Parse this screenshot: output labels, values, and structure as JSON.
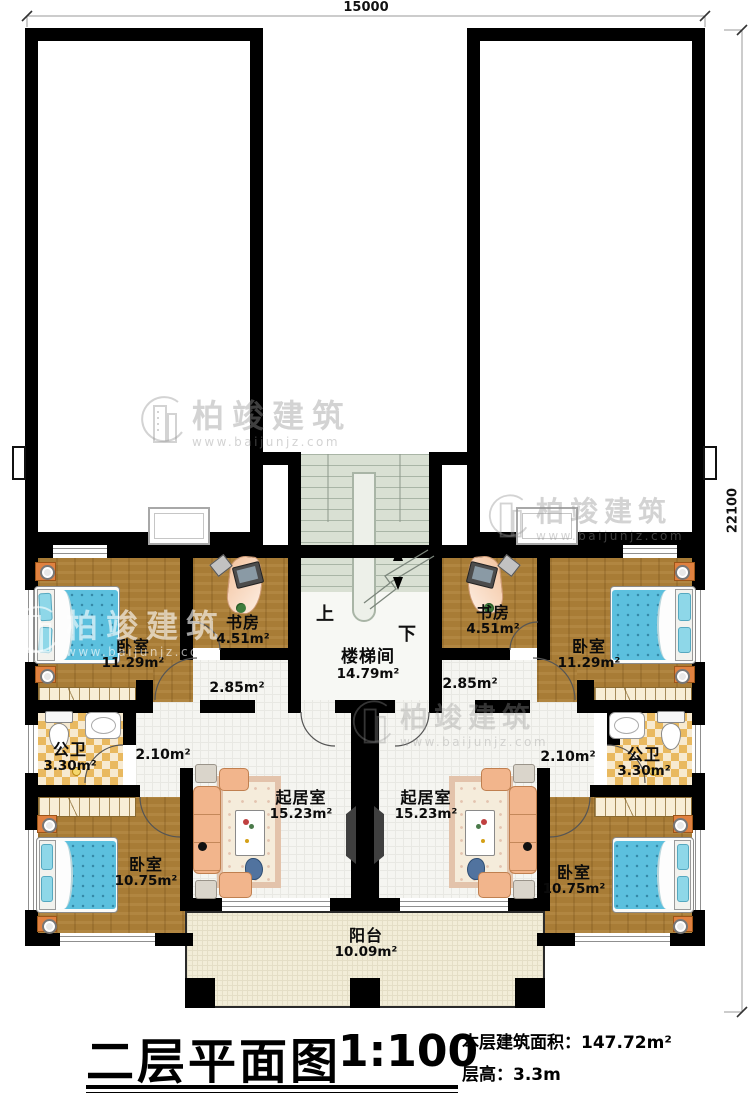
{
  "title_block": {
    "title": "二层平面图",
    "scale": "1:100",
    "area_label": "本层建筑面积：",
    "area_value": "147.72m²",
    "height_label": "层高：",
    "height_value": "3.3m"
  },
  "dimensions": {
    "top": "15000",
    "right": "22100"
  },
  "watermark": {
    "brand": "柏竣建筑",
    "url": "www.baijunjz.com"
  },
  "rooms": {
    "bedroom_tl": {
      "name": "卧室",
      "area": "11.29m²"
    },
    "bedroom_tr": {
      "name": "卧室",
      "area": "11.29m²"
    },
    "bedroom_bl": {
      "name": "卧室",
      "area": "10.75m²"
    },
    "bedroom_br": {
      "name": "卧室",
      "area": "10.75m²"
    },
    "study_l": {
      "name": "书房",
      "area": "4.51m²"
    },
    "study_r": {
      "name": "书房",
      "area": "4.51m²"
    },
    "bath_l": {
      "name": "公卫",
      "area": "3.30m²"
    },
    "bath_r": {
      "name": "公卫",
      "area": "3.30m²"
    },
    "living_l": {
      "name": "起居室",
      "area": "15.23m²"
    },
    "living_r": {
      "name": "起居室",
      "area": "15.23m²"
    },
    "hall_upper_l": {
      "area": "2.85m²"
    },
    "hall_upper_r": {
      "area": "2.85m²"
    },
    "hall_lower_l": {
      "area": "2.10m²"
    },
    "hall_lower_r": {
      "area": "2.10m²"
    },
    "stairwell": {
      "name": "楼梯间",
      "area": "14.79m²",
      "up_label": "上",
      "down_label": "下"
    },
    "balcony": {
      "name": "阳台",
      "area": "10.09m²"
    }
  }
}
